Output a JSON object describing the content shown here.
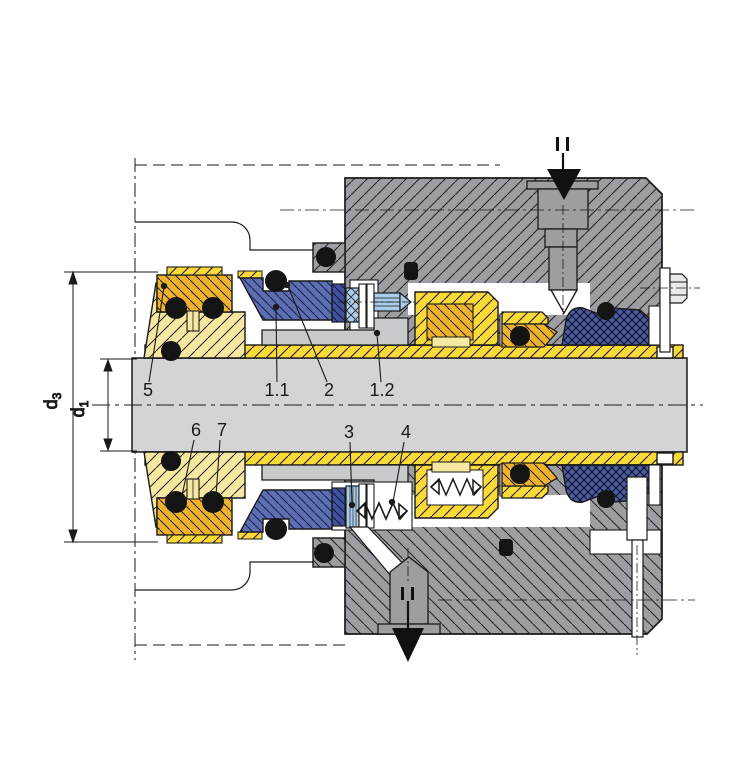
{
  "title": "Mechanical seal cartridge cross-section drawing",
  "part_labels": {
    "p5": "5",
    "p11": "1.1",
    "p2": "2",
    "p12": "1.2",
    "p6": "6",
    "p7": "7",
    "p3": "3",
    "p4": "4"
  },
  "dimensions": {
    "d3_main": "d",
    "d3_sub": "3",
    "d1_main": "d",
    "d1_sub": "1"
  },
  "colors": {
    "gray": "#9c9ea1",
    "gray_light": "#d3d4d6",
    "gray_mid": "#c9cacc",
    "yellow": "#fbd938",
    "yellow_pale": "#f6e8a0",
    "amber": "#efb22d",
    "blue": "#5d6eb2",
    "blue_dark": "#4a5ba8",
    "navy": "#3f519e",
    "blue_light": "#a9cde9",
    "line": "#1a1a1a"
  }
}
